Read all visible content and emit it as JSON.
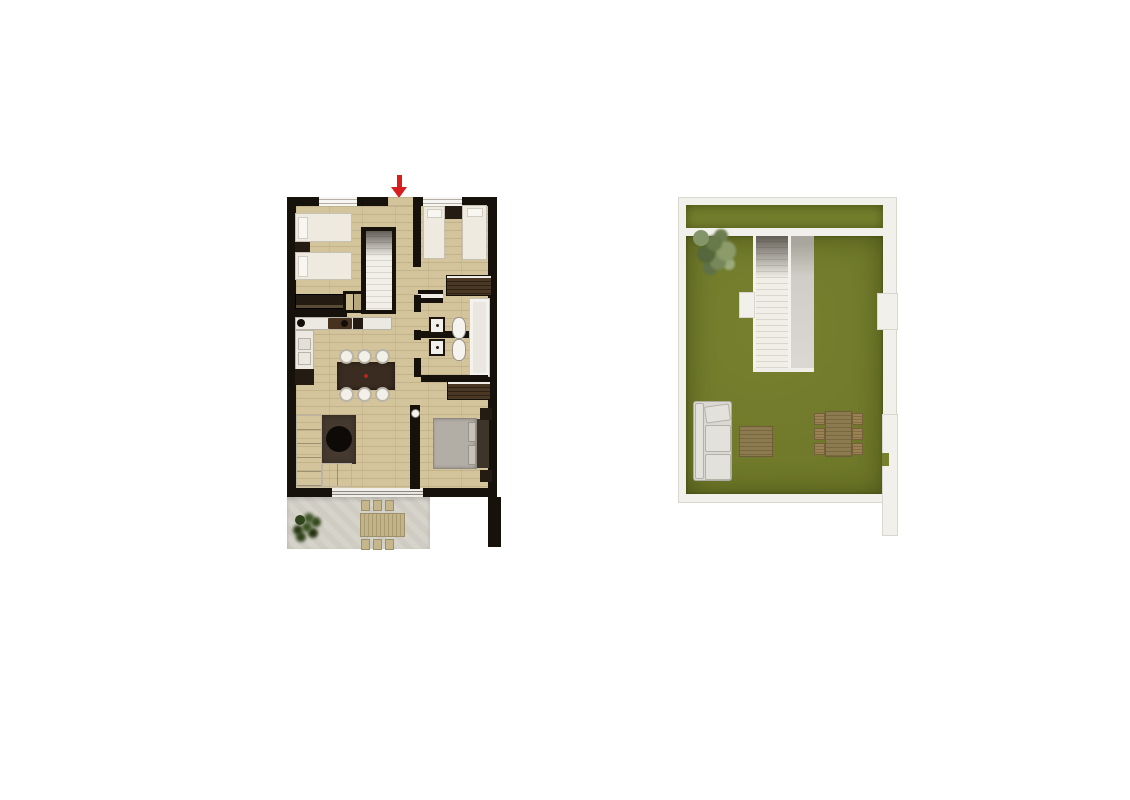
{
  "page": {
    "background": "#ffffff",
    "content": "two top-down architectural floor plans side by side, no text labels"
  },
  "colors": {
    "background": "#ffffff",
    "wall_dark": "#17110b",
    "floor_wood": "#d3c49c",
    "furniture_white": "#eeeae0",
    "furniture_dark": "#241b12",
    "wood_dark": "#3a2c20",
    "wardrobe_brown": "#4a3724",
    "counter_white": "#ebe9e1",
    "bed_gray": "#b2ada5",
    "headboard_dark": "#3e352a",
    "rug_brown": "#463a30",
    "terrace_floor": "#d6d3cb",
    "outdoor_wood": "#c2b389",
    "plant_green": "#31451c",
    "arrow_red": "#d81f1f",
    "grass_green": "#76802e",
    "solarium_wall": "#f1f0ea",
    "solarium_wall_edge": "#d9d7cf",
    "stair_tread": "#d8d6ce",
    "stair_white": "#efede6",
    "gray_panel": "#cfcdc5",
    "sofa_gray": "#dad8d2",
    "table_wood": "#8c7a50",
    "chair_wood": "#9b8254"
  },
  "plans": {
    "apartment": {
      "name": "apartment-floor-plan",
      "entrance_marker": "red-arrow-down",
      "rooms": [
        "bedroom-top-left",
        "bedroom-top-right",
        "bathroom-upper",
        "bathroom-lower",
        "kitchen",
        "dining-area",
        "living-room",
        "master-bedroom",
        "hallway",
        "staircase",
        "terrace"
      ],
      "furniture": [
        "twin-beds",
        "nightstands",
        "wardrobes",
        "stairs",
        "kitchen-counter",
        "sink",
        "stove",
        "dining-table-6-chairs",
        "l-shaped-sofa",
        "rug",
        "round-coffee-table",
        "double-bed",
        "sinks",
        "toilets",
        "shower",
        "outdoor-table-6-chairs",
        "plant"
      ]
    },
    "solarium": {
      "name": "roof-terrace-plan",
      "features": [
        "lawn",
        "upper-lawn-strip",
        "stairwell",
        "gray-walkway",
        "tree",
        "left-planter",
        "right-planter",
        "outdoor-sofa",
        "coffee-table",
        "dining-table-6-chairs",
        "side-wall-strip"
      ]
    }
  }
}
